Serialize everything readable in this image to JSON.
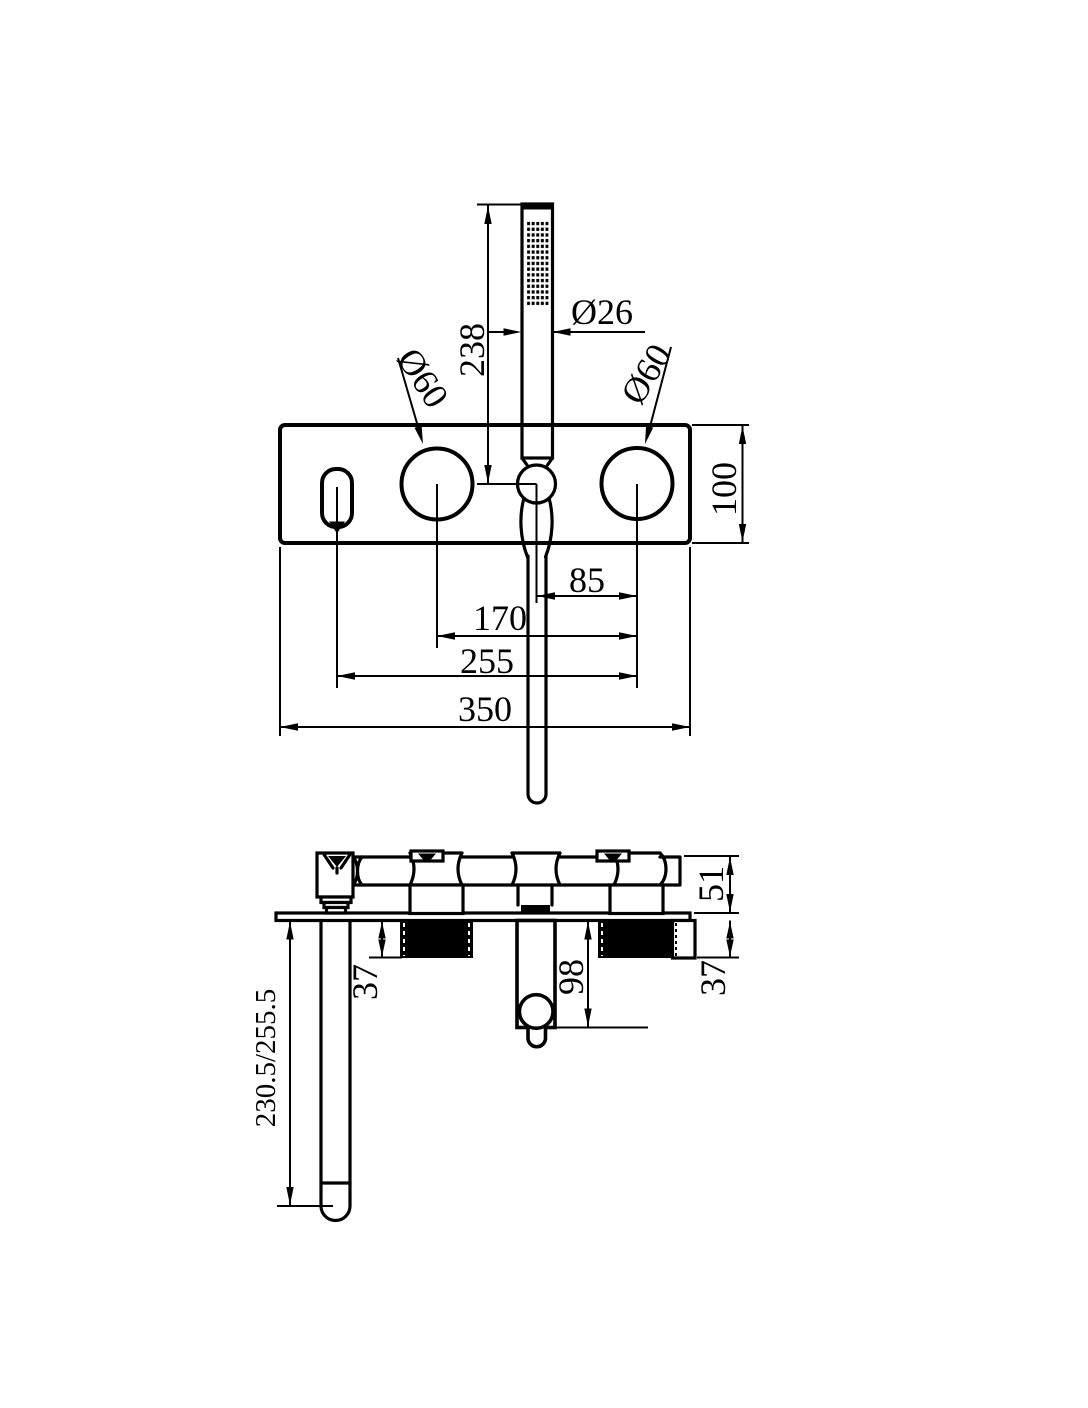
{
  "drawing": {
    "colors": {
      "line": "#000000",
      "background": "#ffffff"
    },
    "top_view": {
      "handshower_length": "238",
      "handshower_diameter": "Ø26",
      "left_handle_diameter": "Ø60",
      "right_handle_diameter": "Ø60",
      "plate_height": "100",
      "hose_to_right_handle": "85",
      "handle_spacing": "170",
      "spout_to_right_handle": "255",
      "plate_width": "350"
    },
    "side_view": {
      "body_projection": "51",
      "left_valve_depth": "37",
      "holder_depth": "98",
      "right_valve_depth": "37",
      "spout_reach": "230.5/255.5"
    }
  }
}
